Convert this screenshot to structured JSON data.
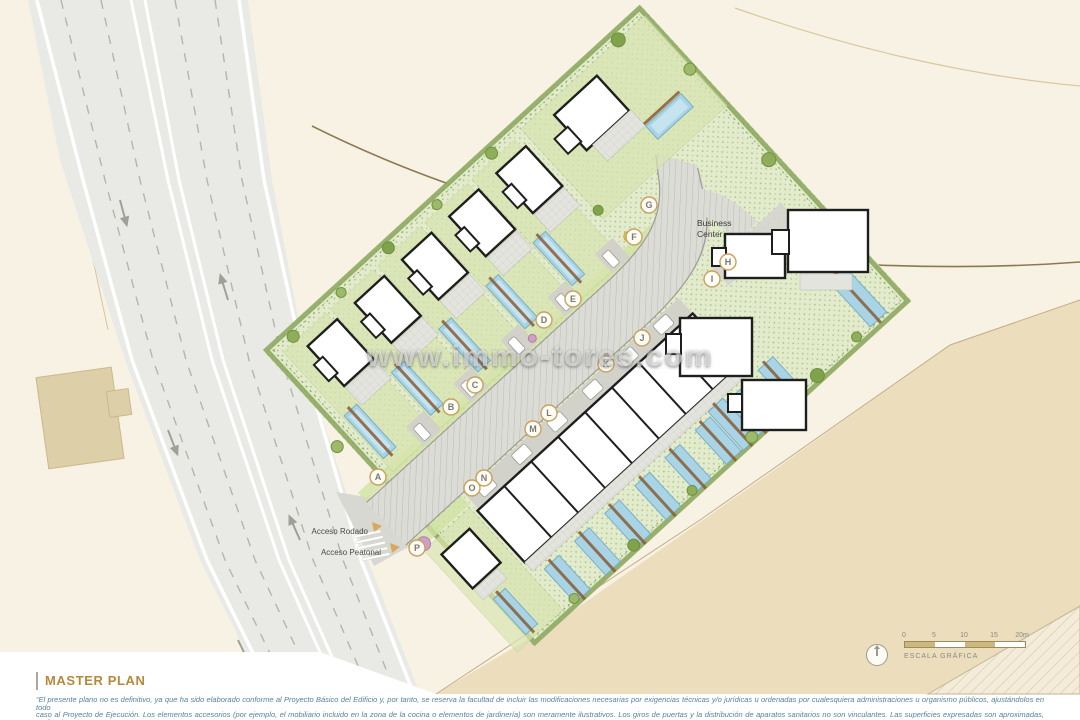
{
  "title": {
    "label": "MASTER PLAN"
  },
  "watermark": {
    "text": "www.immo-tores.com"
  },
  "map": {
    "business_center": {
      "line1": "Business",
      "line2": "Center"
    },
    "access_labels": {
      "rodado": "Acceso Rodado",
      "peatonal": "Acceso Peatonal"
    },
    "plots": [
      {
        "letter": "A"
      },
      {
        "letter": "B"
      },
      {
        "letter": "C"
      },
      {
        "letter": "D"
      },
      {
        "letter": "E"
      },
      {
        "letter": "F"
      },
      {
        "letter": "G"
      },
      {
        "letter": "H"
      },
      {
        "letter": "I"
      },
      {
        "letter": "J"
      },
      {
        "letter": "K"
      },
      {
        "letter": "L"
      },
      {
        "letter": "M"
      },
      {
        "letter": "N"
      },
      {
        "letter": "O"
      },
      {
        "letter": "P"
      }
    ]
  },
  "scale_bar": {
    "ticks": [
      "0",
      "5",
      "10",
      "15",
      "20m"
    ],
    "caption": "ESCALA GRÁFICA"
  },
  "disclaimer": {
    "line1": "“El presente plano no es definitivo, ya que ha sido elaborado conforme al Proyecto Básico del Edificio y, por tanto, se reserva la facultad de incluir las modificaciones necesarias por exigencias técnicas y/o jurídicas u ordenadas por cualesquiera administraciones u organismo públicos, ajustándolos en todo",
    "line2": "caso al Proyecto de Ejecución. Los elementos accesorios (por ejemplo, el mobiliario incluido en la zona de la cocina o elementos de jardinería) son meramente ilustrativos. Los giros de puertas y la distribución de aparatos sanitarios no son vinculantes. Las superficies expresadas son aproximadas, pudiendo",
    "line3": "experimentar modificaciones por razones de índole técnica y/o legal en el desarrollo de la ejecución de las obras.”"
  },
  "colors": {
    "background": "#f8f2e5",
    "site_green": "#e3ebcd",
    "pool_blue": "#a9d4e6",
    "terrain_tan": "#ecddbd",
    "title_accent": "#b8883a",
    "disclaimer_text": "#55829c",
    "plot_marker_ring": "#c9a05f"
  }
}
